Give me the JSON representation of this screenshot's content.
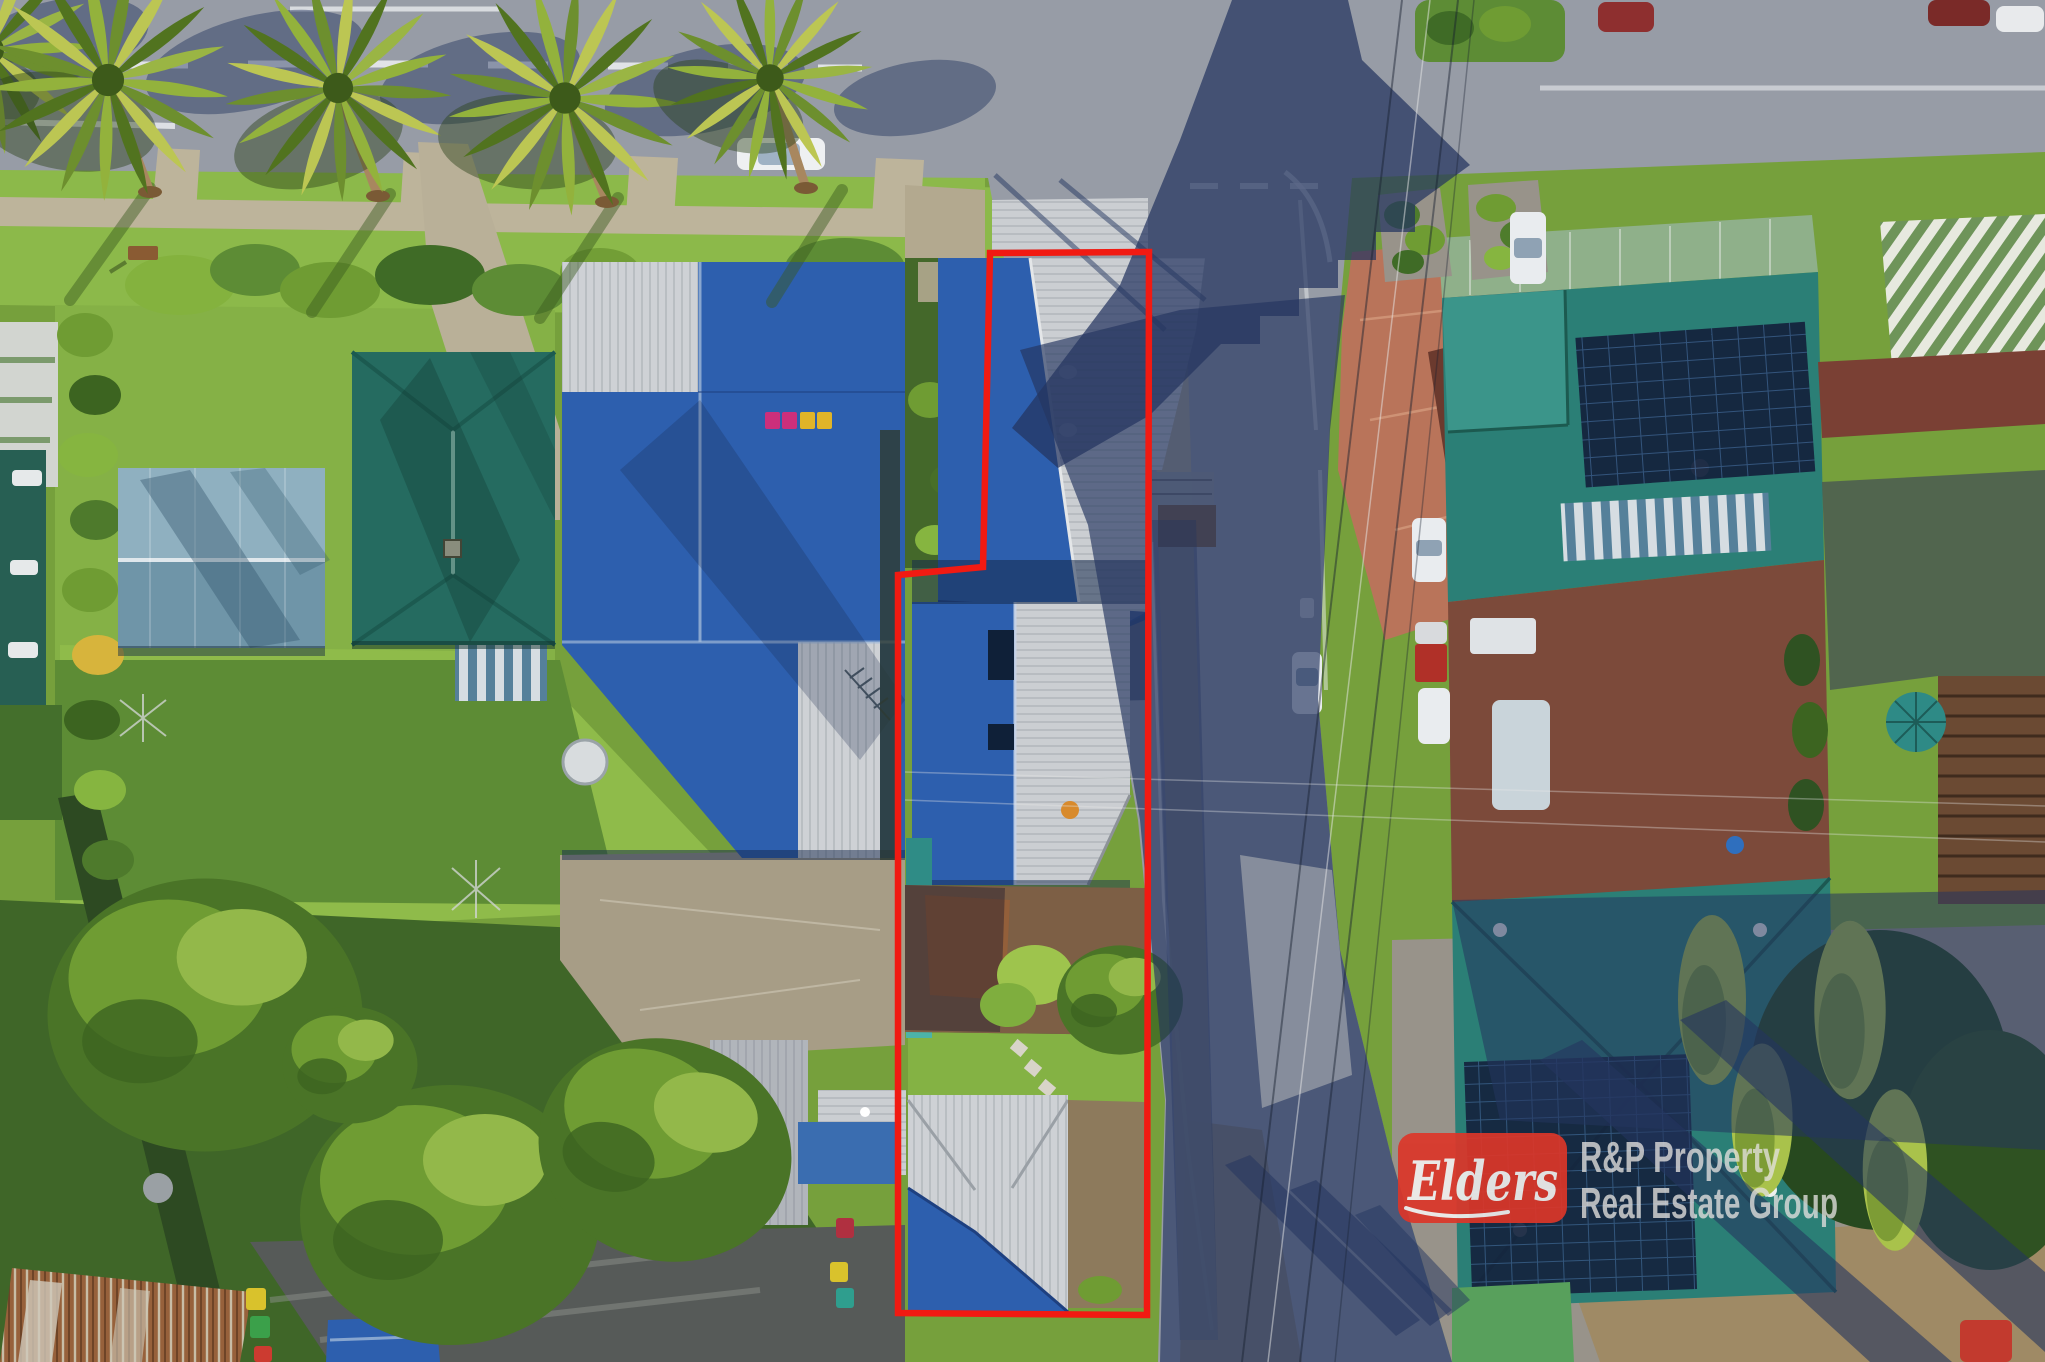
{
  "canvas": {
    "width": 2045,
    "height": 1362
  },
  "watermark": {
    "brand": "Elders",
    "agency_line1": "R&P Property",
    "agency_line2": "Real Estate Group",
    "box_color": "#dc3629",
    "text_color": "#e2e0dd"
  },
  "boundary": {
    "points": "990,253 1149,252 1147,1315 898,1313 898,575 983,567",
    "color": "#f11a12",
    "stroke_width": "6.5"
  },
  "palette": {
    "grass": "#76a03c",
    "road": "#979ca6",
    "shadow_navy": "#24355f",
    "roof_blue": "#2d5fae",
    "roof_gray": "#c9ccd0",
    "roof_teal": "#2b7f76",
    "roof_steel_blue": "#8fb0c0",
    "concrete": "#bdb49b"
  }
}
